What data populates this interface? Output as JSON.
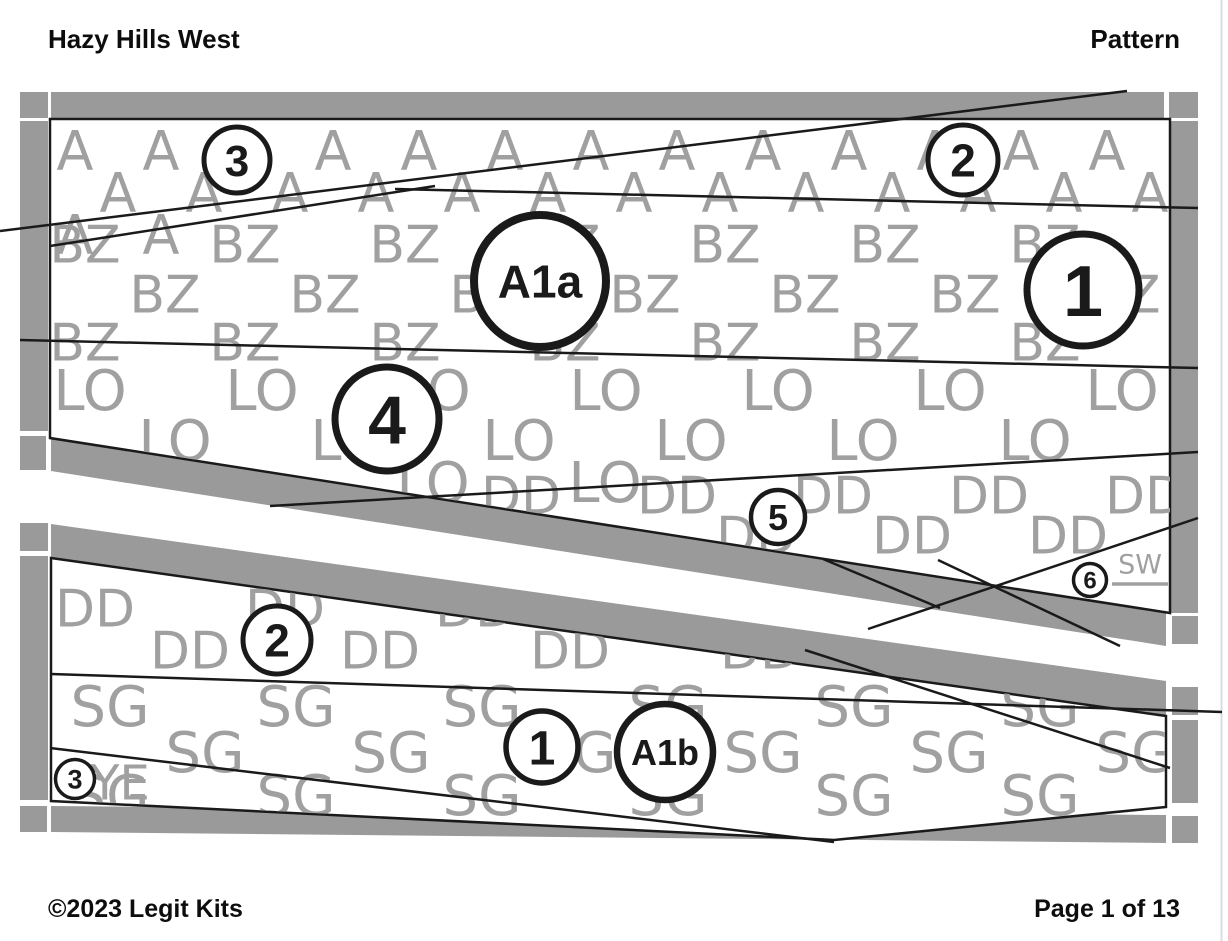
{
  "header": {
    "title": "Hazy Hills West",
    "doc_type": "Pattern"
  },
  "footer": {
    "copyright": "©2023 Legit Kits",
    "page_indicator": "Page 1 of 13"
  },
  "colors": {
    "border_gray": "#9a9a9a",
    "letter_gray": "#a0a0a0",
    "line_black": "#1a1a1a",
    "page_edge": "#dcdcdc"
  },
  "fabric_codes": [
    "A",
    "BZ",
    "LO",
    "DD",
    "SG",
    "YE",
    "SW"
  ],
  "sections": [
    {
      "id": "A1a",
      "position": "top"
    },
    {
      "id": "A1b",
      "position": "bottom"
    }
  ],
  "watermark_bands": [
    {
      "section": "top",
      "letter": "A",
      "font_size": 54,
      "rows": [
        {
          "cy": 150,
          "x0": 75,
          "dx": 86,
          "n": 13
        },
        {
          "cy": 192,
          "x0": 118,
          "dx": 86,
          "n": 13
        },
        {
          "cy": 234,
          "x0": 75,
          "dx": 86,
          "n": 2
        }
      ]
    },
    {
      "section": "top",
      "letter": "BZ",
      "font_size": 52,
      "rows": [
        {
          "cy": 244,
          "x0": 85,
          "dx": 160,
          "n": 8
        },
        {
          "cy": 294,
          "x0": 165,
          "dx": 160,
          "n": 8
        },
        {
          "cy": 342,
          "x0": 85,
          "dx": 160,
          "n": 8
        }
      ]
    },
    {
      "section": "top",
      "letter": "LO",
      "font_size": 56,
      "rows": [
        {
          "cy": 390,
          "x0": 90,
          "dx": 172,
          "n": 7
        },
        {
          "cy": 440,
          "x0": 175,
          "dx": 172,
          "n": 7
        },
        {
          "cy": 482,
          "x0": 433,
          "dx": 172,
          "n": 2
        }
      ]
    },
    {
      "section": "top",
      "letter": "DD",
      "font_size": 52,
      "rows": [
        {
          "cy": 495,
          "x0": 521,
          "dx": 156,
          "n": 5
        },
        {
          "cy": 535,
          "x0": 756,
          "dx": 156,
          "n": 3
        }
      ]
    },
    {
      "section": "bottom",
      "letter": "DD",
      "font_size": 52,
      "rows": [
        {
          "cy": 608,
          "x0": 95,
          "dx": 190,
          "n": 6
        },
        {
          "cy": 650,
          "x0": 190,
          "dx": 190,
          "n": 6
        }
      ]
    },
    {
      "section": "bottom",
      "letter": "SG",
      "font_size": 56,
      "rows": [
        {
          "cy": 706,
          "x0": 110,
          "dx": 186,
          "n": 6
        },
        {
          "cy": 752,
          "x0": 205,
          "dx": 186,
          "n": 6
        },
        {
          "cy": 795,
          "x0": 110,
          "dx": 186,
          "n": 6
        }
      ]
    },
    {
      "section": "bottom",
      "letter": "YE",
      "font_size": 48,
      "rows": [
        {
          "cy": 782,
          "x0": 120,
          "dx": 0,
          "n": 1
        }
      ]
    }
  ],
  "piece_markers": [
    {
      "label": "3",
      "x": 237,
      "y": 160,
      "r": 33,
      "font_size": 44,
      "stroke_width": 5
    },
    {
      "label": "2",
      "x": 963,
      "y": 160,
      "r": 35,
      "font_size": 46,
      "stroke_width": 5
    },
    {
      "label": "A1a",
      "x": 540,
      "y": 281,
      "r": 66,
      "font_size": 46,
      "stroke_width": 8
    },
    {
      "label": "1",
      "x": 1083,
      "y": 290,
      "r": 56,
      "font_size": 72,
      "stroke_width": 7
    },
    {
      "label": "4",
      "x": 387,
      "y": 419,
      "r": 52,
      "font_size": 68,
      "stroke_width": 7
    },
    {
      "label": "5",
      "x": 778,
      "y": 517,
      "r": 27,
      "font_size": 36,
      "stroke_width": 4.5
    },
    {
      "label": "6",
      "x": 1090,
      "y": 580,
      "r": 16.5,
      "font_size": 24,
      "stroke_width": 3.5
    },
    {
      "label": "2",
      "x": 277,
      "y": 640,
      "r": 34,
      "font_size": 46,
      "stroke_width": 5
    },
    {
      "label": "1",
      "x": 542,
      "y": 747,
      "r": 36,
      "font_size": 48,
      "stroke_width": 5.5
    },
    {
      "label": "A1b",
      "x": 665,
      "y": 752,
      "r": 48,
      "font_size": 36,
      "stroke_width": 6.5
    },
    {
      "label": "3",
      "x": 75,
      "y": 779,
      "r": 19.5,
      "font_size": 27,
      "stroke_width": 3.5
    }
  ],
  "sw_label": {
    "text": "SW",
    "x": 1140,
    "y": 564,
    "font_size": 27,
    "underline": {
      "x1": 1112,
      "x2": 1168,
      "y": 584
    }
  }
}
